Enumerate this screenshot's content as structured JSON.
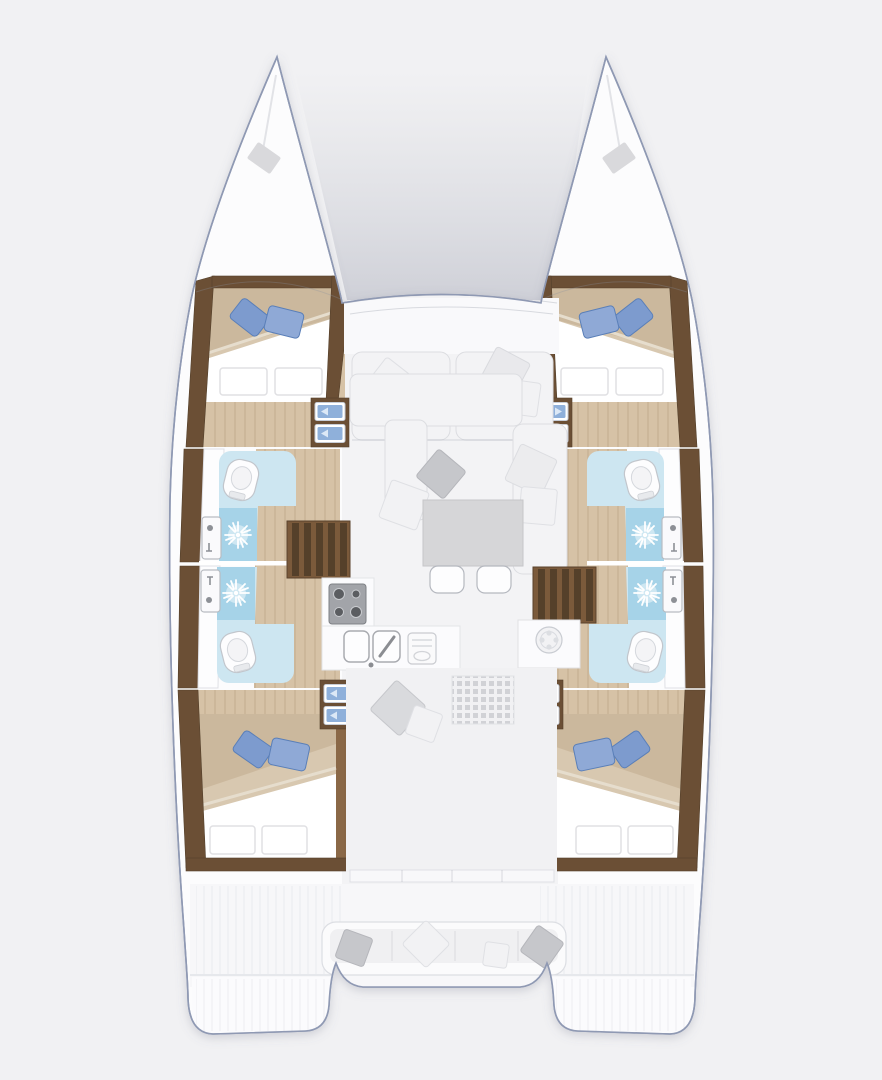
{
  "title": "Catamaran interior floor plan",
  "palette": {
    "background": "#f1f1f3",
    "hull_fill": "#fcfcfd",
    "hull_outline": "#8f99b3",
    "wood_dark": "#6b4f35",
    "wood_mid": "#8a6847",
    "wood_tread": "#55402a",
    "floor_light": "#d6c2a6",
    "mattress": "#d8c8b0",
    "duvet": "#ffffff",
    "pillow_blue": "#7d9bce",
    "pillow_blue_dark": "#5a7fb8",
    "bath_floor": "#cde6f1",
    "shower_tile": "#a6d3e8",
    "fixture_white": "#fdfdfe",
    "fixture_stroke": "#b5b8bf",
    "sofa": "#f3f3f5",
    "sofa_stroke": "#dcdde1",
    "cushion_gray": "#c6c7cb",
    "table_gray": "#d6d6d8",
    "steps_blue": "#8fb0da"
  },
  "regions": {
    "boat": {
      "label": "Catamaran hull top view"
    },
    "port_bow": {
      "label": "Port bow with anchor locker"
    },
    "starboard_bow": {
      "label": "Starboard bow with anchor locker"
    },
    "trampoline": {
      "label": "Foredeck area between bows"
    },
    "foredeck_lounge": {
      "label": "Forward salon lounge seats with pillows"
    },
    "port_forward_cabin": {
      "label": "Port forward double cabin with blue pillows"
    },
    "starboard_forward_cabin": {
      "label": "Starboard forward double cabin with blue pillows"
    },
    "port_forward_head": {
      "label": "Port forward bathroom with toilet, sink and shower"
    },
    "port_aft_head": {
      "label": "Port aft bathroom with toilet, sink and shower"
    },
    "starboard_forward_head": {
      "label": "Starboard forward bathroom with toilet, sink and shower"
    },
    "starboard_aft_head": {
      "label": "Starboard aft bathroom with toilet, sink and shower"
    },
    "port_aft_cabin": {
      "label": "Port aft double cabin with blue pillows"
    },
    "starboard_aft_cabin": {
      "label": "Starboard aft double cabin with blue pillows"
    },
    "salon": {
      "label": "Salon with settee, cushions and table"
    },
    "salon_table": {
      "label": "Salon table with two stools"
    },
    "galley": {
      "label": "Galley with four-burner stove, double sink and drainer"
    },
    "port_stairs": {
      "label": "Port companionway staircase"
    },
    "starboard_stairs": {
      "label": "Starboard companionway staircase"
    },
    "companionway_steps": {
      "label": "Blue entry steps to hull cabins"
    },
    "aft_walkway": {
      "label": "Aft salon walkway with floor hatch and pillows"
    },
    "aft_door": {
      "label": "Sliding door to cockpit"
    },
    "aft_cockpit": {
      "label": "Aft cockpit bench with cushions"
    },
    "port_transom": {
      "label": "Port transom swim steps"
    },
    "starboard_transom": {
      "label": "Starboard transom swim steps"
    }
  }
}
